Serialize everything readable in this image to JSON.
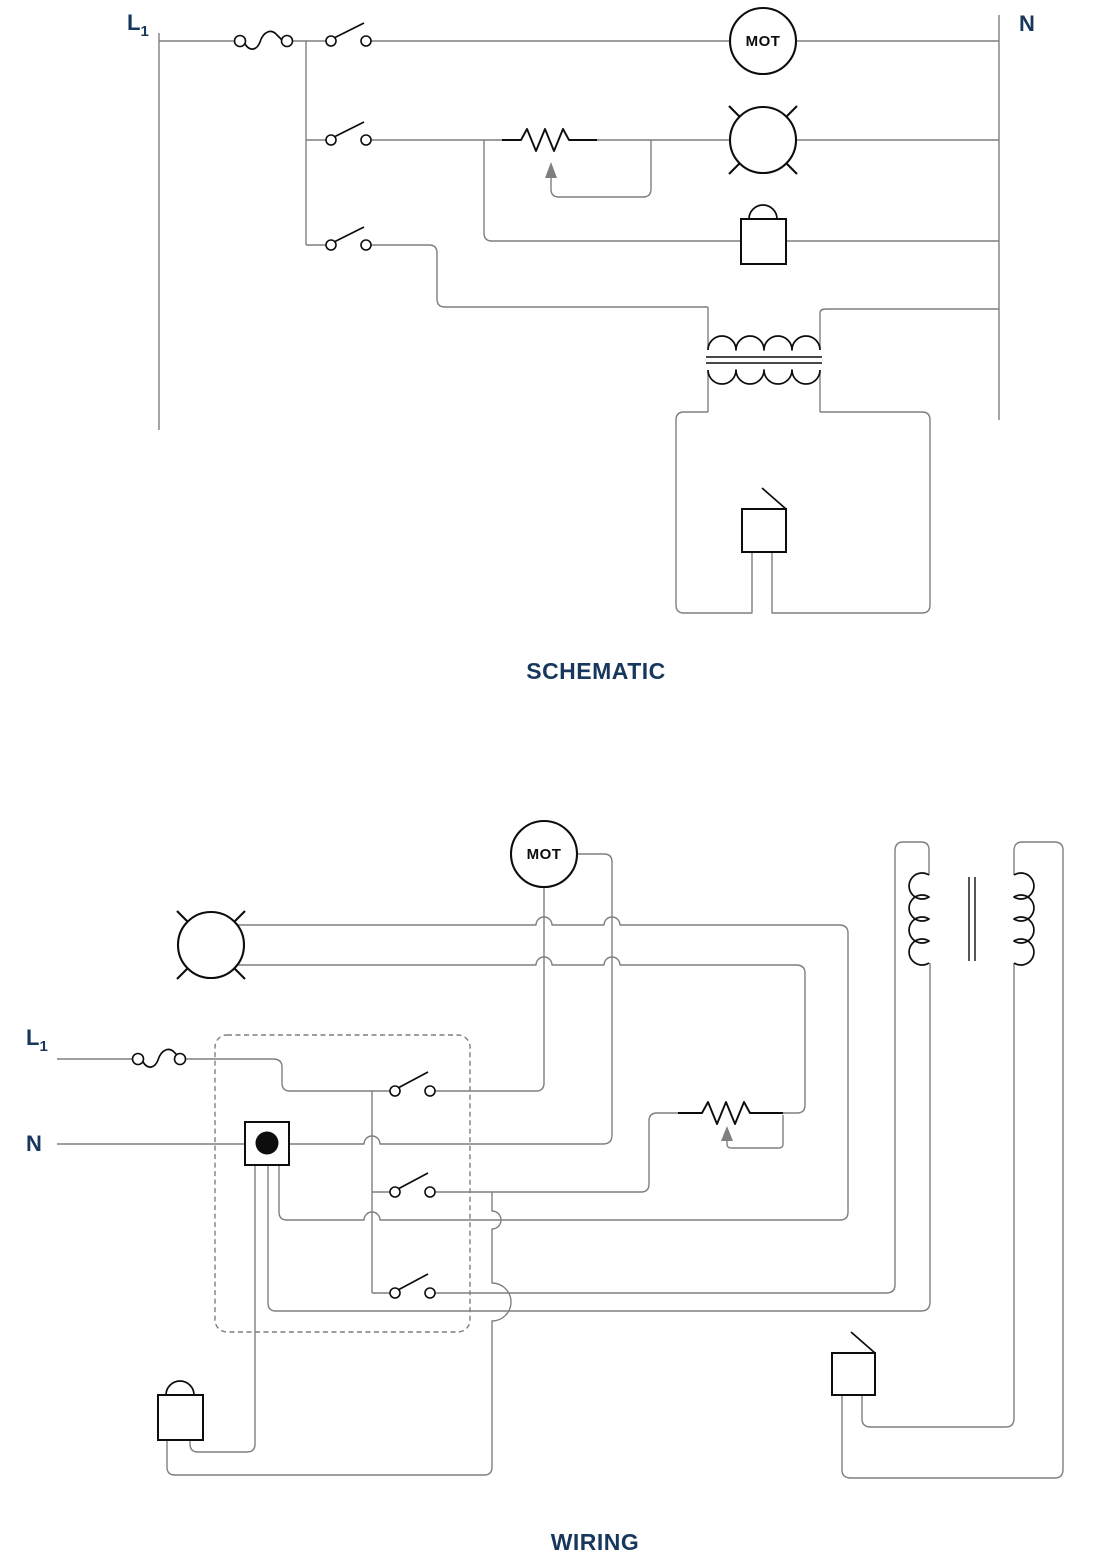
{
  "colors": {
    "background": "#ffffff",
    "wire": "#7f7f7f",
    "symbol": "#0d0d0d",
    "label": "#17375d",
    "arrow": "#7f7f7f"
  },
  "schematic": {
    "caption": "SCHEMATIC",
    "line_label": "L",
    "line_label_sub": "1",
    "neutral_label": "N",
    "motor_label": "MOT"
  },
  "wiring": {
    "caption": "WIRING",
    "line_label": "L",
    "line_label_sub": "1",
    "neutral_label": "N",
    "motor_label": "MOT"
  }
}
